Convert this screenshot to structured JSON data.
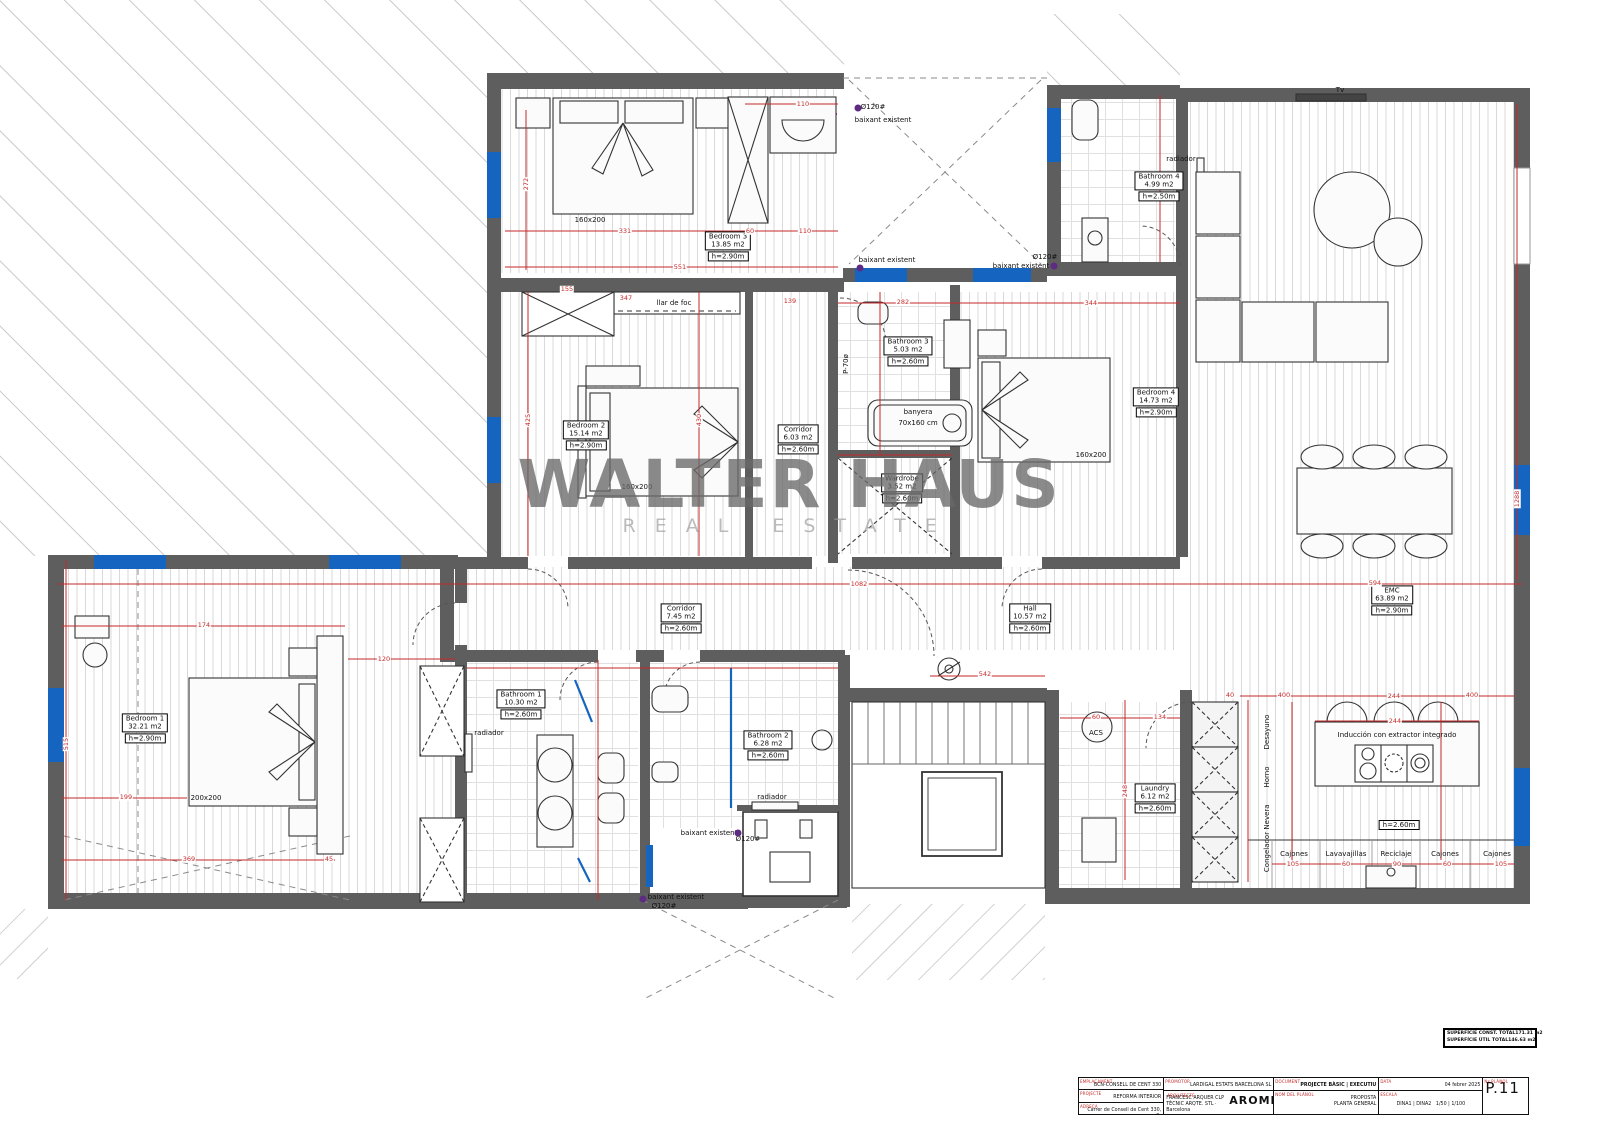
{
  "watermark": {
    "title": "WALTER HAUS",
    "subtitle": "REAL ESTATE"
  },
  "rooms": [
    {
      "name": "Bedroom 3",
      "area": "13.85 m2",
      "height": "h=2.90m",
      "x": 728,
      "y": 248
    },
    {
      "name": "Bedroom 2",
      "area": "15.14 m2",
      "height": "h=2.90m",
      "x": 586,
      "y": 437
    },
    {
      "name": "Corridor",
      "area": "6.03 m2",
      "height": "h=2.60m",
      "x": 798,
      "y": 441
    },
    {
      "name": "Bathroom 3",
      "area": "5.03 m2",
      "height": "h=2.60m",
      "x": 908,
      "y": 353
    },
    {
      "name": "Bedroom 4",
      "area": "14.73 m2",
      "height": "h=2.90m",
      "x": 1156,
      "y": 404
    },
    {
      "name": "Bathroom 4",
      "area": "4.99 m2",
      "height": "h=2.50m",
      "x": 1159,
      "y": 188
    },
    {
      "name": "Wardrobe",
      "area": "3.52 m2",
      "height": "h=2.60m",
      "x": 902,
      "y": 490
    },
    {
      "name": "Corridor",
      "area": "7.45 m2",
      "height": "h=2.60m",
      "x": 681,
      "y": 620
    },
    {
      "name": "Hall",
      "area": "10.57 m2",
      "height": "h=2.60m",
      "x": 1030,
      "y": 620
    },
    {
      "name": "EMC",
      "area": "63.89 m2",
      "height": "h=2.90m",
      "x": 1392,
      "y": 602
    },
    {
      "name": "Bedroom 1",
      "area": "32.21 m2",
      "height": "h=2.90m",
      "x": 145,
      "y": 730
    },
    {
      "name": "Bathroom 1",
      "area": "10.30 m2",
      "height": "h=2.60m",
      "x": 521,
      "y": 706
    },
    {
      "name": "Bathroom 2",
      "area": "6.28 m2",
      "height": "h=2.60m",
      "x": 768,
      "y": 747
    },
    {
      "name": "Laundry",
      "area": "6.12 m2",
      "height": "h=2.60m",
      "x": 1155,
      "y": 800
    }
  ],
  "annotations": [
    {
      "text": "llar de foc",
      "x": 674,
      "y": 303
    },
    {
      "text": "radiador",
      "x": 1181,
      "y": 159
    },
    {
      "text": "radiador",
      "x": 489,
      "y": 733
    },
    {
      "text": "radiador",
      "x": 772,
      "y": 797
    },
    {
      "text": "banyera",
      "x": 918,
      "y": 412
    },
    {
      "text": "70x160 cm",
      "x": 918,
      "y": 423
    },
    {
      "text": "160x200",
      "x": 590,
      "y": 220
    },
    {
      "text": "160x200",
      "x": 637,
      "y": 487
    },
    {
      "text": "160x200",
      "x": 1091,
      "y": 455
    },
    {
      "text": "200x200",
      "x": 206,
      "y": 798
    },
    {
      "text": "Tv",
      "x": 1340,
      "y": 90
    },
    {
      "text": "ACS",
      "x": 1096,
      "y": 733
    },
    {
      "text": "baixant existent",
      "x": 883,
      "y": 120
    },
    {
      "text": "Ø120#",
      "x": 873,
      "y": 107
    },
    {
      "text": "baixant existent",
      "x": 887,
      "y": 260
    },
    {
      "text": "baixant existent",
      "x": 1021,
      "y": 266
    },
    {
      "text": "Ø120#",
      "x": 1045,
      "y": 257
    },
    {
      "text": "baixant existent",
      "x": 709,
      "y": 833
    },
    {
      "text": "Ø120#",
      "x": 748,
      "y": 839
    },
    {
      "text": "baixant existent",
      "x": 676,
      "y": 897
    },
    {
      "text": "Ø120#",
      "x": 664,
      "y": 906
    },
    {
      "text": "Inducción con extractor integrado",
      "x": 1397,
      "y": 735
    },
    {
      "text": "h=2.60m",
      "x": 1399,
      "y": 825,
      "boxed": true
    },
    {
      "text": "Desayuno",
      "x": 1267,
      "y": 732,
      "rot": true
    },
    {
      "text": "Horno",
      "x": 1267,
      "y": 777,
      "rot": true
    },
    {
      "text": "Nevera",
      "x": 1267,
      "y": 817,
      "rot": true
    },
    {
      "text": "Congelador",
      "x": 1267,
      "y": 852,
      "rot": true
    },
    {
      "text": "Cajones",
      "x": 1294,
      "y": 854
    },
    {
      "text": "Lavavajillas",
      "x": 1346,
      "y": 854
    },
    {
      "text": "Reciclaje",
      "x": 1396,
      "y": 854
    },
    {
      "text": "Cajones",
      "x": 1445,
      "y": 854
    },
    {
      "text": "Cajones",
      "x": 1497,
      "y": 854
    },
    {
      "text": "P-70ø",
      "x": 846,
      "y": 364,
      "rot": true
    }
  ],
  "dimensions": [
    {
      "v": "331",
      "x": 625,
      "y": 231
    },
    {
      "v": "60",
      "x": 750,
      "y": 231
    },
    {
      "v": "110",
      "x": 805,
      "y": 231
    },
    {
      "v": "110",
      "x": 803,
      "y": 104
    },
    {
      "v": "272",
      "x": 526,
      "y": 184,
      "rot": true
    },
    {
      "v": "551",
      "x": 680,
      "y": 267
    },
    {
      "v": "155",
      "x": 567,
      "y": 289
    },
    {
      "v": "347",
      "x": 626,
      "y": 298
    },
    {
      "v": "139",
      "x": 790,
      "y": 301
    },
    {
      "v": "282",
      "x": 903,
      "y": 302
    },
    {
      "v": "344",
      "x": 1091,
      "y": 303
    },
    {
      "v": "425",
      "x": 528,
      "y": 420,
      "rot": true
    },
    {
      "v": "430",
      "x": 699,
      "y": 420,
      "rot": true
    },
    {
      "v": "1082",
      "x": 859,
      "y": 584
    },
    {
      "v": "594",
      "x": 1375,
      "y": 583
    },
    {
      "v": "1288",
      "x": 1517,
      "y": 499,
      "rot": true
    },
    {
      "v": "542",
      "x": 985,
      "y": 674
    },
    {
      "v": "515",
      "x": 66,
      "y": 744,
      "rot": true
    },
    {
      "v": "199",
      "x": 126,
      "y": 797
    },
    {
      "v": "174",
      "x": 204,
      "y": 625
    },
    {
      "v": "120",
      "x": 384,
      "y": 659
    },
    {
      "v": "369",
      "x": 189,
      "y": 859
    },
    {
      "v": "45",
      "x": 329,
      "y": 859
    },
    {
      "v": "60",
      "x": 1096,
      "y": 717
    },
    {
      "v": "134",
      "x": 1160,
      "y": 717
    },
    {
      "v": "248",
      "x": 1125,
      "y": 791,
      "rot": true
    },
    {
      "v": "40",
      "x": 1230,
      "y": 695
    },
    {
      "v": "400",
      "x": 1284,
      "y": 695
    },
    {
      "v": "244",
      "x": 1394,
      "y": 696
    },
    {
      "v": "400",
      "x": 1472,
      "y": 695
    },
    {
      "v": "244",
      "x": 1395,
      "y": 721
    },
    {
      "v": "105",
      "x": 1293,
      "y": 864
    },
    {
      "v": "60",
      "x": 1346,
      "y": 864
    },
    {
      "v": "90",
      "x": 1397,
      "y": 864
    },
    {
      "v": "60",
      "x": 1447,
      "y": 864
    },
    {
      "v": "105",
      "x": 1501,
      "y": 864
    }
  ],
  "dots": [
    {
      "x": 858,
      "y": 108
    },
    {
      "x": 860,
      "y": 268
    },
    {
      "x": 1054,
      "y": 266
    },
    {
      "x": 738,
      "y": 833
    },
    {
      "x": 643,
      "y": 899
    }
  ],
  "titleblock": {
    "c1": {
      "l1_label": "EMPLAÇAMENT",
      "l1": "BCN-CONSELL DE CENT 330",
      "l2_label": "PROJECTE",
      "l2": "REFORMA INTERIOR",
      "l3_label": "ADREÇA",
      "l3a": "Carrer de Consell de Cent 330, 3r",
      "l3b": "08007, Barcelona"
    },
    "c2": {
      "l1_label": "PROMOTOR",
      "l1": "LARDIGAL ESTATS BARCELONA SL",
      "l2_label": "ARQUITECTE",
      "l2a": "FRANCESC ARQUER CLP",
      "l2b": "TÈCNIC ARQTE. STL · Barcelona",
      "logo": "AROMIR"
    },
    "c3": {
      "l1_label": "DOCUMENT",
      "l1": "PROJECTE BÀSIC | EXECUTIU",
      "l2_label": "NOM DEL PLÀNOL",
      "l2": "PROPOSTA",
      "l3": "PLANTA GENERAL"
    },
    "c4": {
      "l1_label": "DATA",
      "l1": "04 febrer 2025",
      "l2_label": "ESCALA",
      "l2": "DINA1  |  DINA2",
      "l3": "1/50  |  1/100"
    },
    "c5": {
      "l_label": "Nº PLÀNOL",
      "num": "P.11"
    },
    "areas": {
      "r1_label": "SUPERFÍCIE CONST. TOTAL",
      "r1_value": "171.31 m2",
      "r2_label": "SUPERFÍCIE ÚTIL TOTAL",
      "r2_value": "146.63 m2"
    }
  }
}
